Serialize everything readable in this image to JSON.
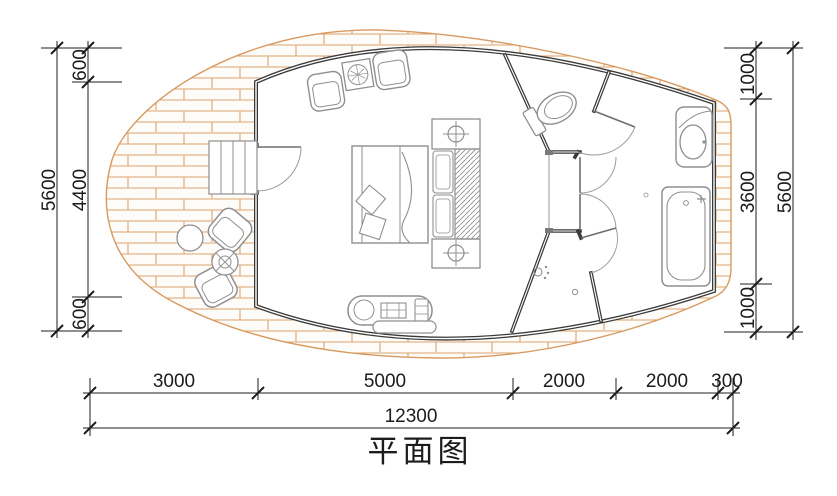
{
  "title": "平面图",
  "dimensions": {
    "left": {
      "total": "5600",
      "top": "600",
      "middle": "4400",
      "bottom": "600"
    },
    "right": {
      "total": "5600",
      "top": "1000",
      "middle": "3600",
      "bottom": "1000"
    },
    "bottom": {
      "segments": [
        "3000",
        "5000",
        "2000",
        "2000",
        "300"
      ],
      "total": "12300"
    }
  },
  "colors": {
    "deck_line": "#d79a62",
    "wall": "#3a3a3a",
    "furniture": "#949494",
    "dim": "#1c1c1c"
  }
}
